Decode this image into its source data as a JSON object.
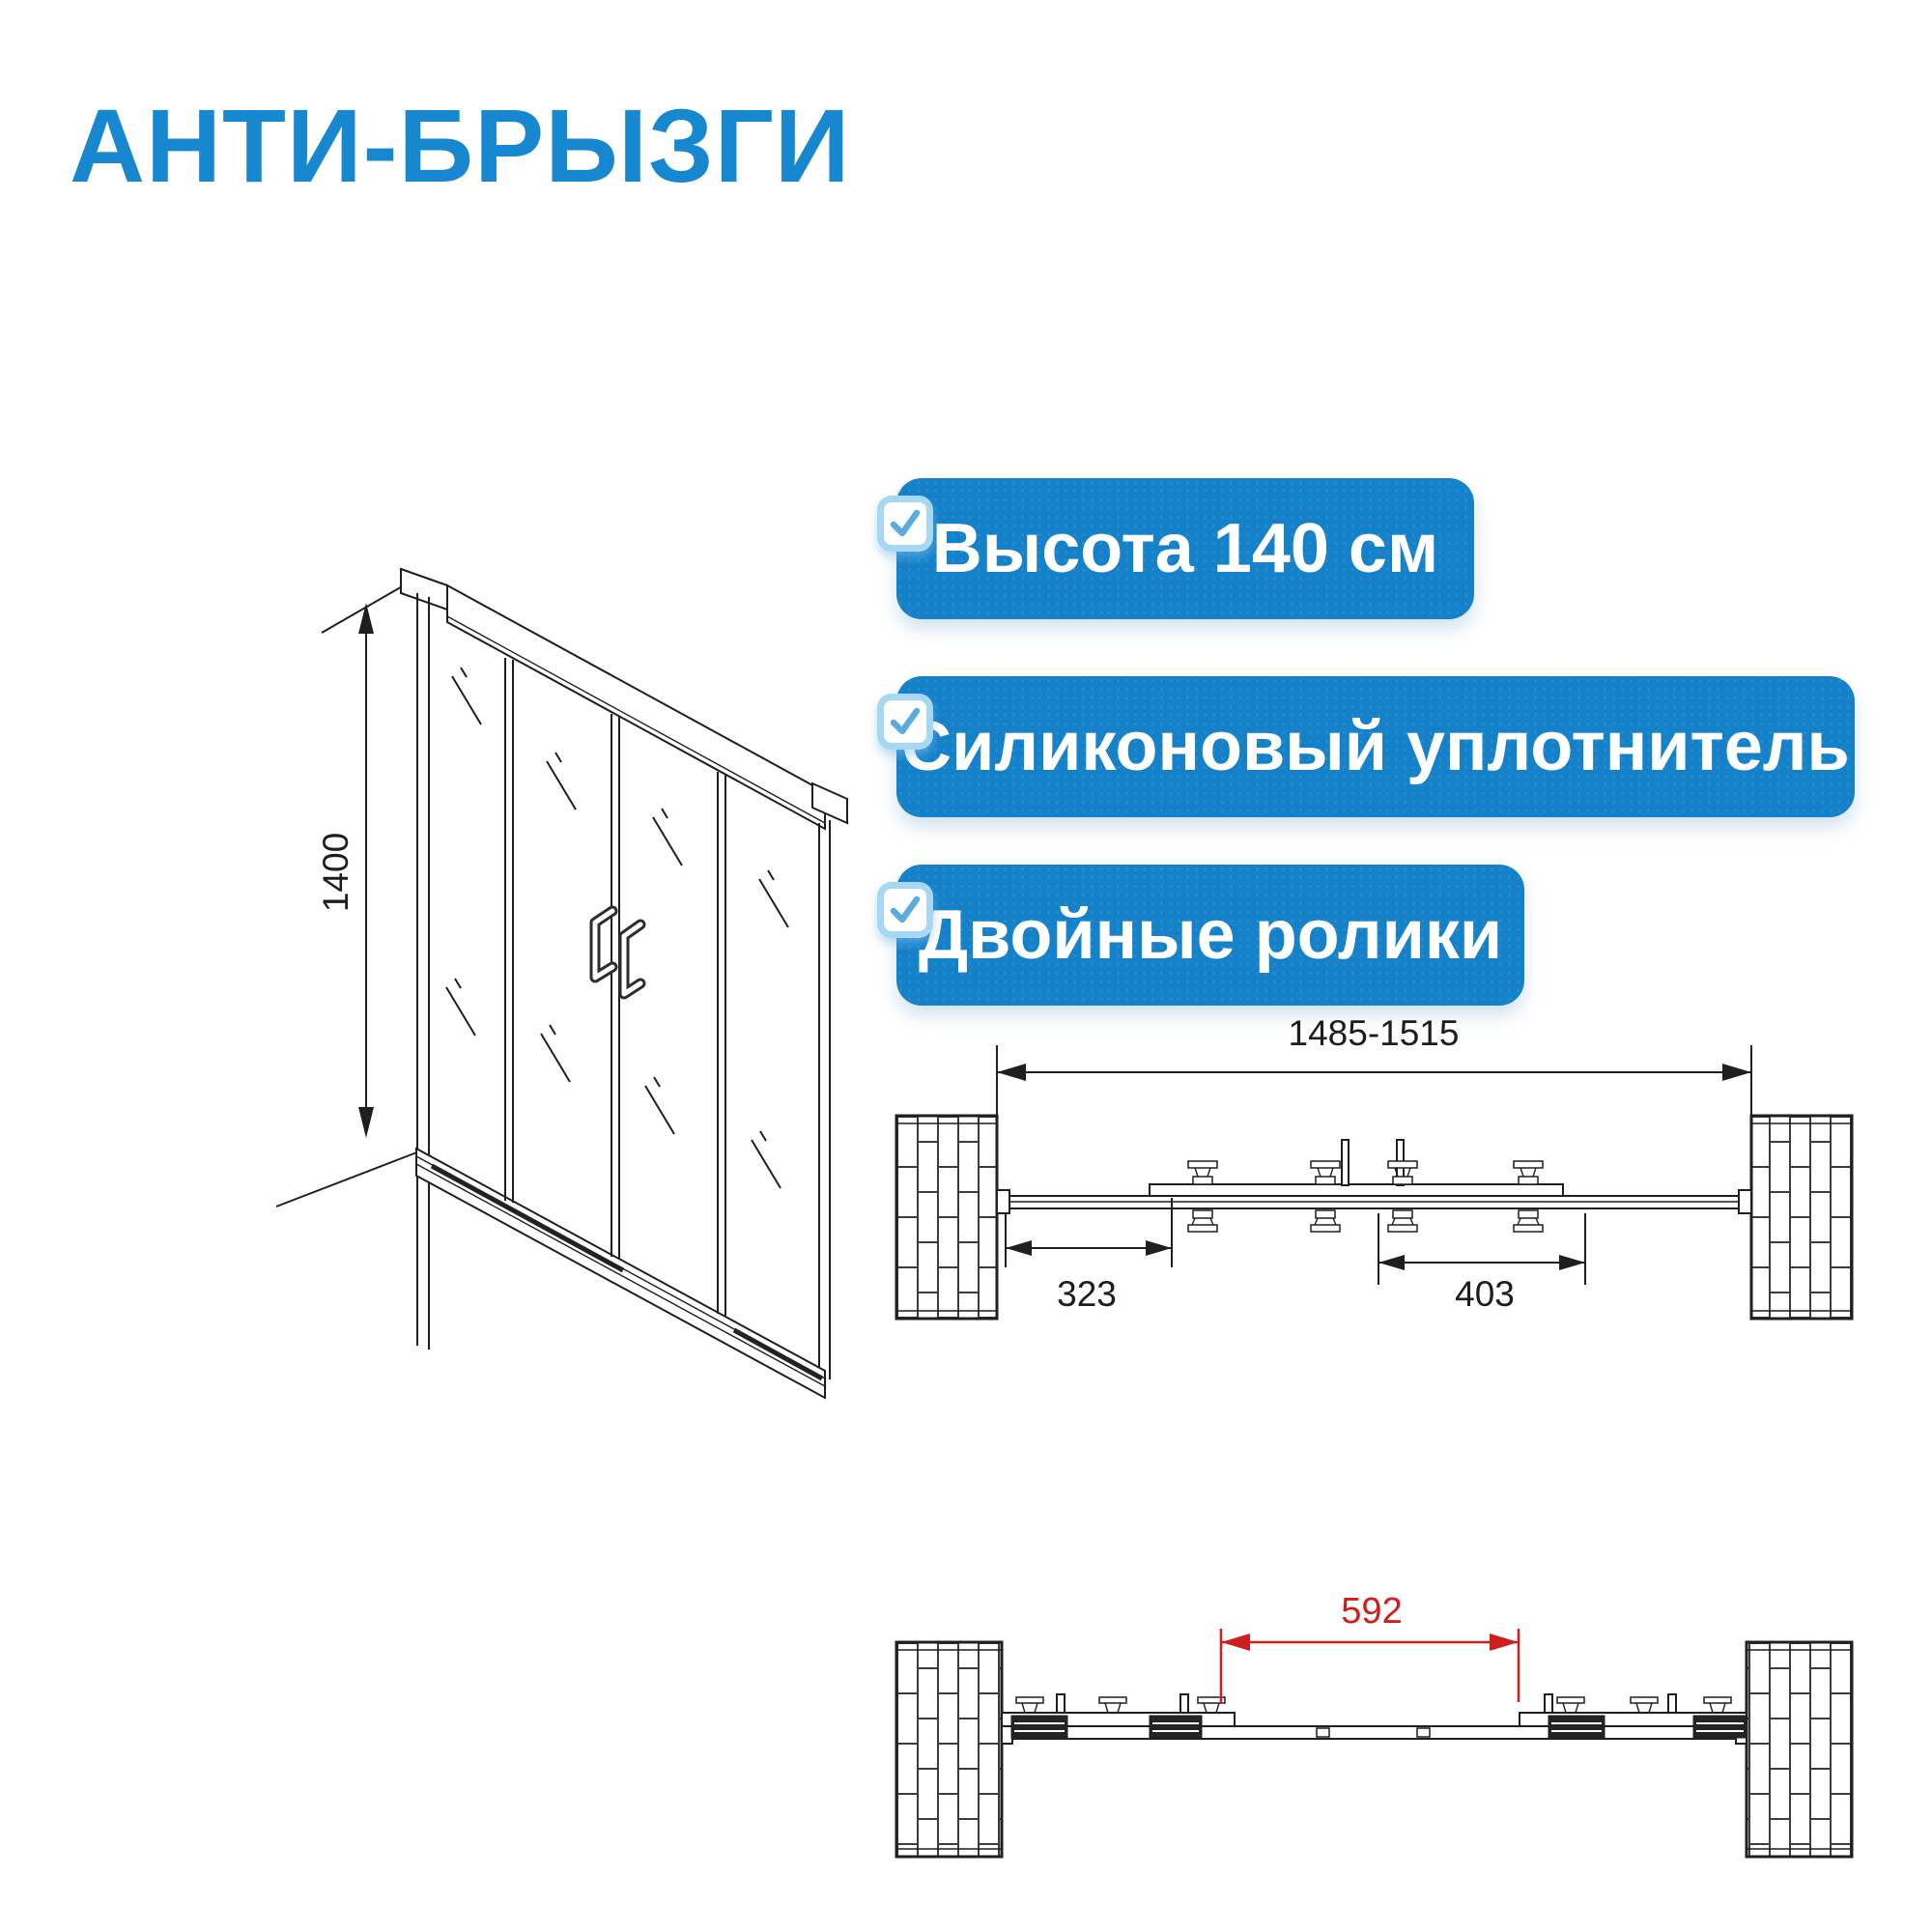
{
  "title": {
    "text": "АНТИ-БРЫЗГИ",
    "color": "#1787d0"
  },
  "features": {
    "badge_color": "#1581c9",
    "text_color": "#ffffff",
    "checkbox": {
      "fill": "#ffffff",
      "border_color": "#a6d7f3",
      "check_color": "#5cabdf"
    },
    "items": [
      {
        "label": "Высота 140 см"
      },
      {
        "label": "Силиконовый уплотнитель"
      },
      {
        "label": "Двойные ролики"
      }
    ]
  },
  "drawings": {
    "line_color": "#1f1f1f",
    "front_view": {
      "height_dimension_mm": "1400"
    },
    "top_view_closed": {
      "overall_width_mm": "1485-1515",
      "left_panel_offset_mm": "323",
      "right_panel_offset_mm": "403"
    },
    "top_view_open": {
      "clear_opening_mm": "592",
      "dimension_color": "#ce1e1e"
    }
  }
}
